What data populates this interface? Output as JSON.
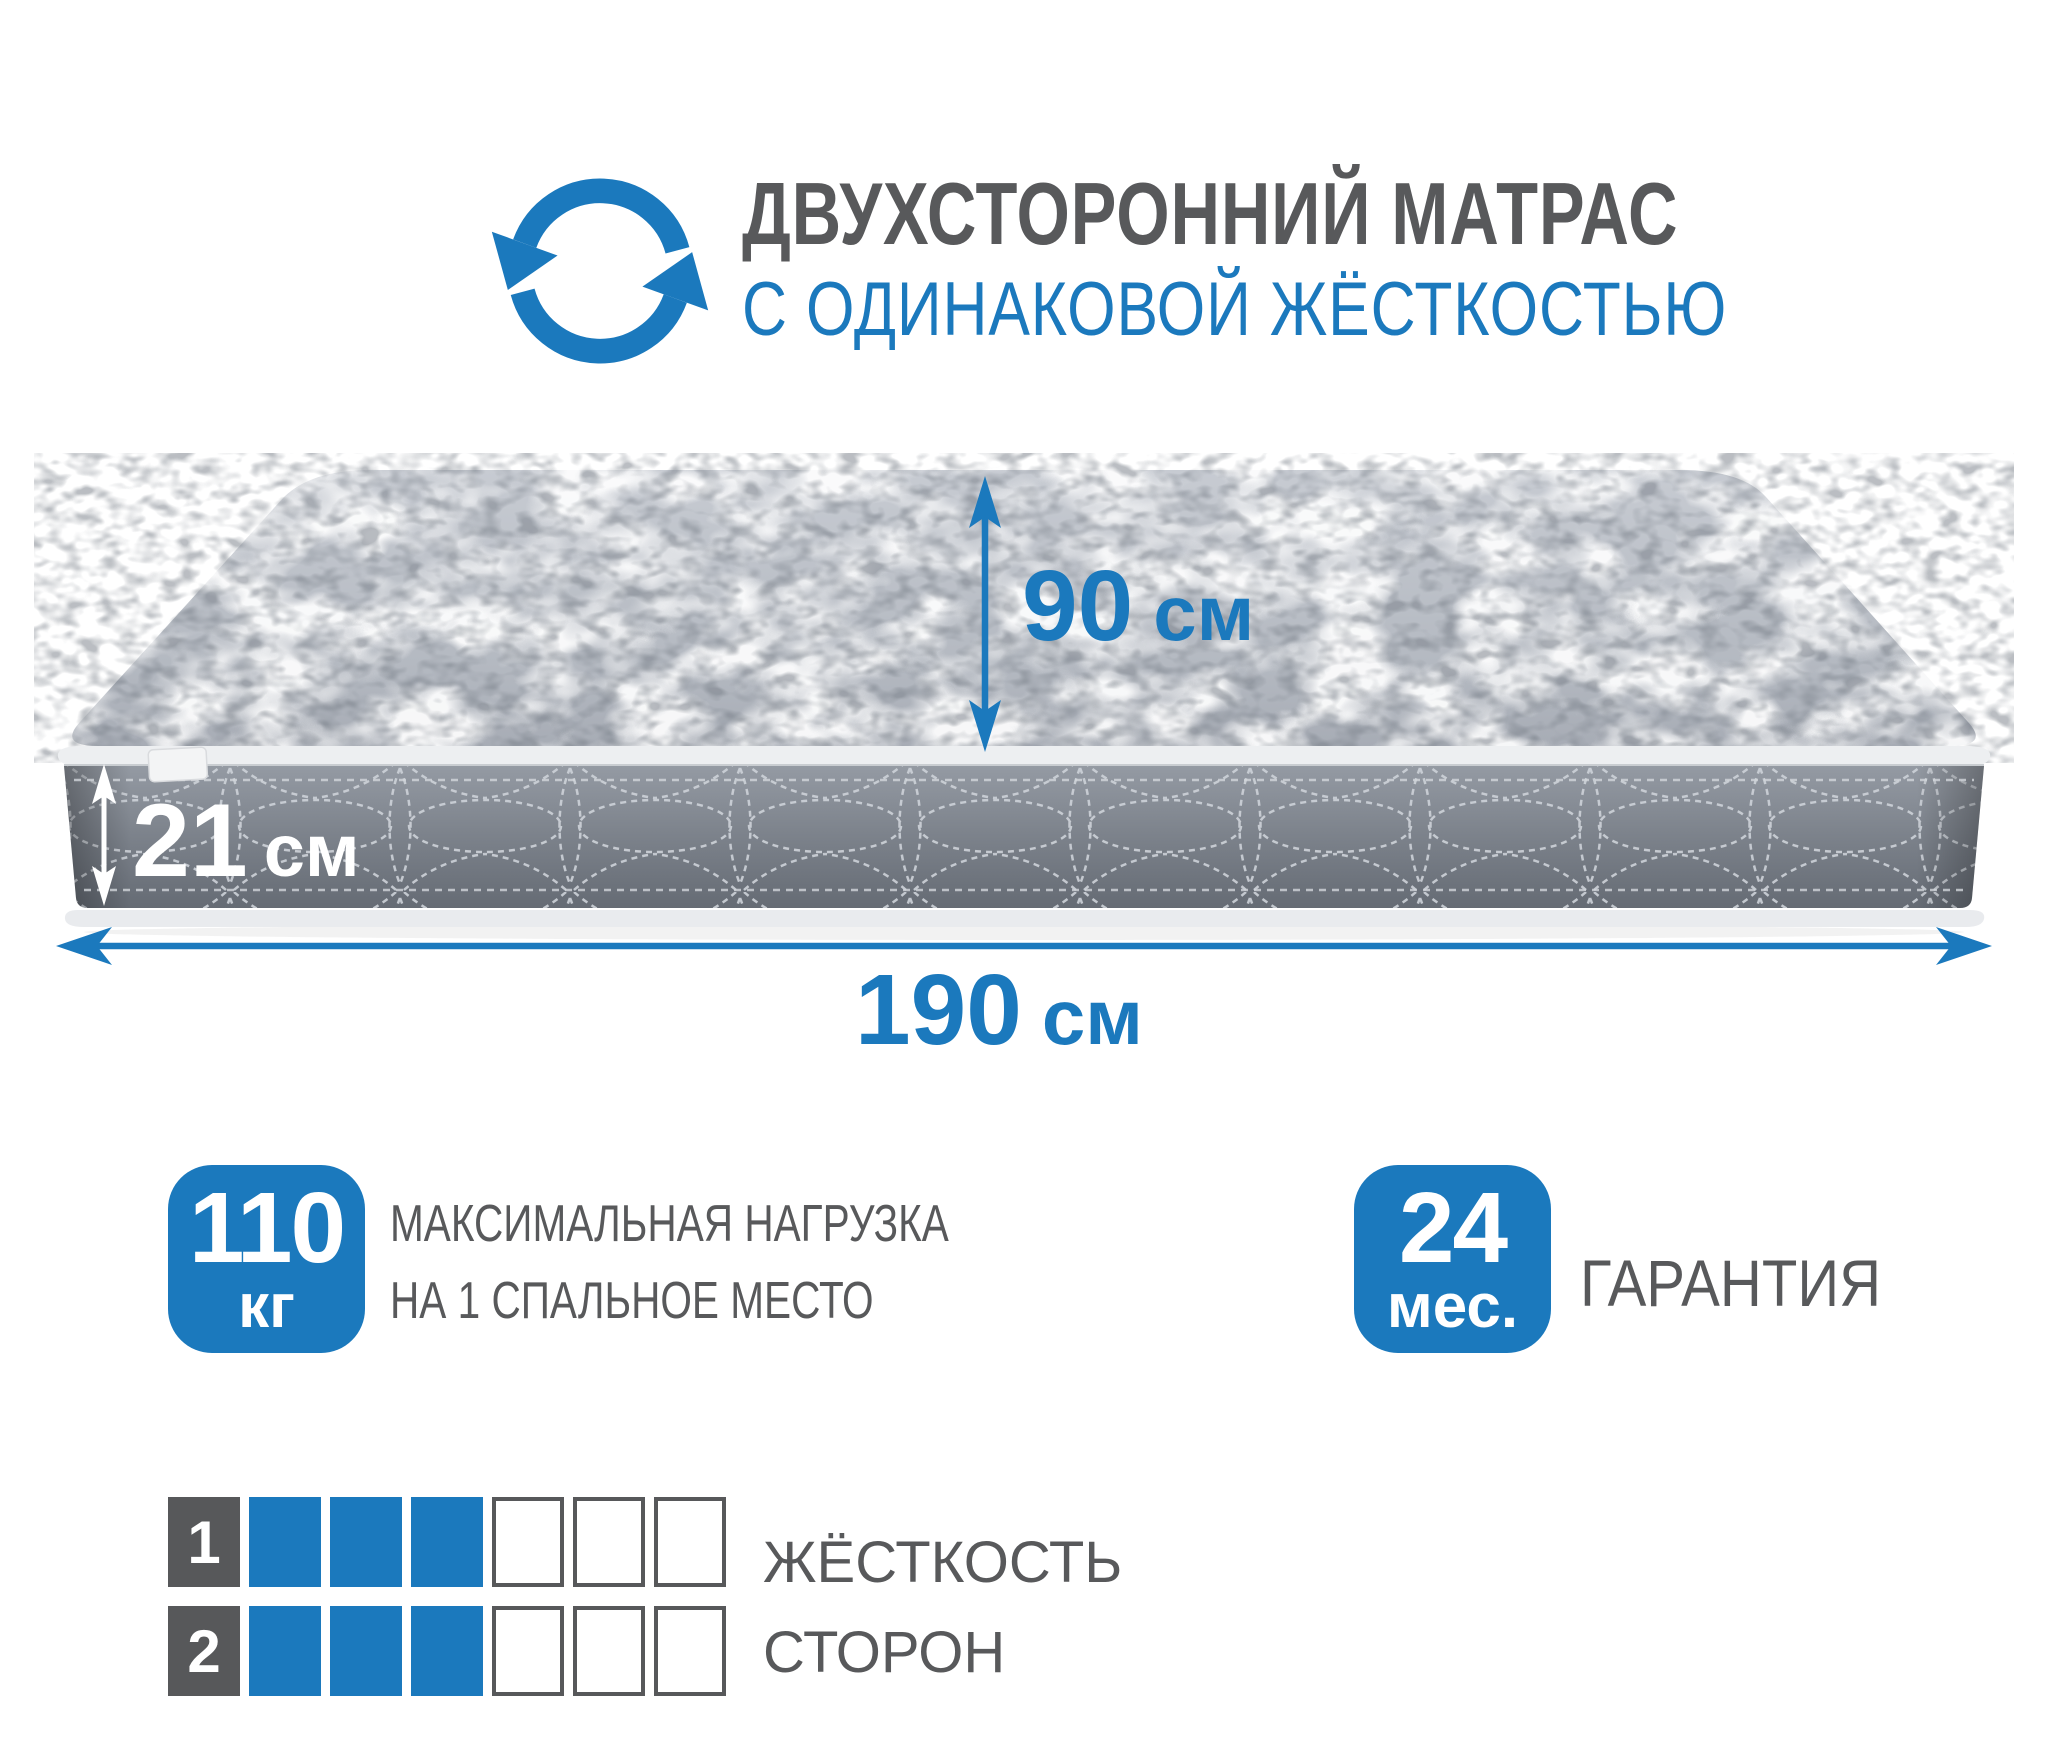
{
  "colors": {
    "accent": "#1b79bd",
    "heading": "#58595b"
  },
  "header": {
    "icon": "rotate-arrows",
    "title": "ДВУХСТОРОННИЙ МАТРАС",
    "subtitle": "С ОДИНАКОВОЙ ЖЁСТКОСТЬЮ"
  },
  "mattress": {
    "dimensions": {
      "width": {
        "value": "90",
        "unit": "см"
      },
      "height": {
        "value": "21",
        "unit": "см"
      },
      "length": {
        "value": "190",
        "unit": "см"
      }
    }
  },
  "features": {
    "max_load": {
      "value": "110",
      "unit": "кг",
      "label_line1": "МАКСИМАЛЬНАЯ НАГРУЗКА",
      "label_line2": "НА 1 СПАЛЬНОЕ МЕСТО"
    },
    "warranty": {
      "value": "24",
      "unit": "мес.",
      "label": "ГАРАНТИЯ"
    }
  },
  "firmness": {
    "label_line1": "ЖЁСТКОСТЬ",
    "label_line2": "СТОРОН",
    "scale_max": 6,
    "sides": [
      {
        "number": "1",
        "value": 3
      },
      {
        "number": "2",
        "value": 3
      }
    ]
  }
}
